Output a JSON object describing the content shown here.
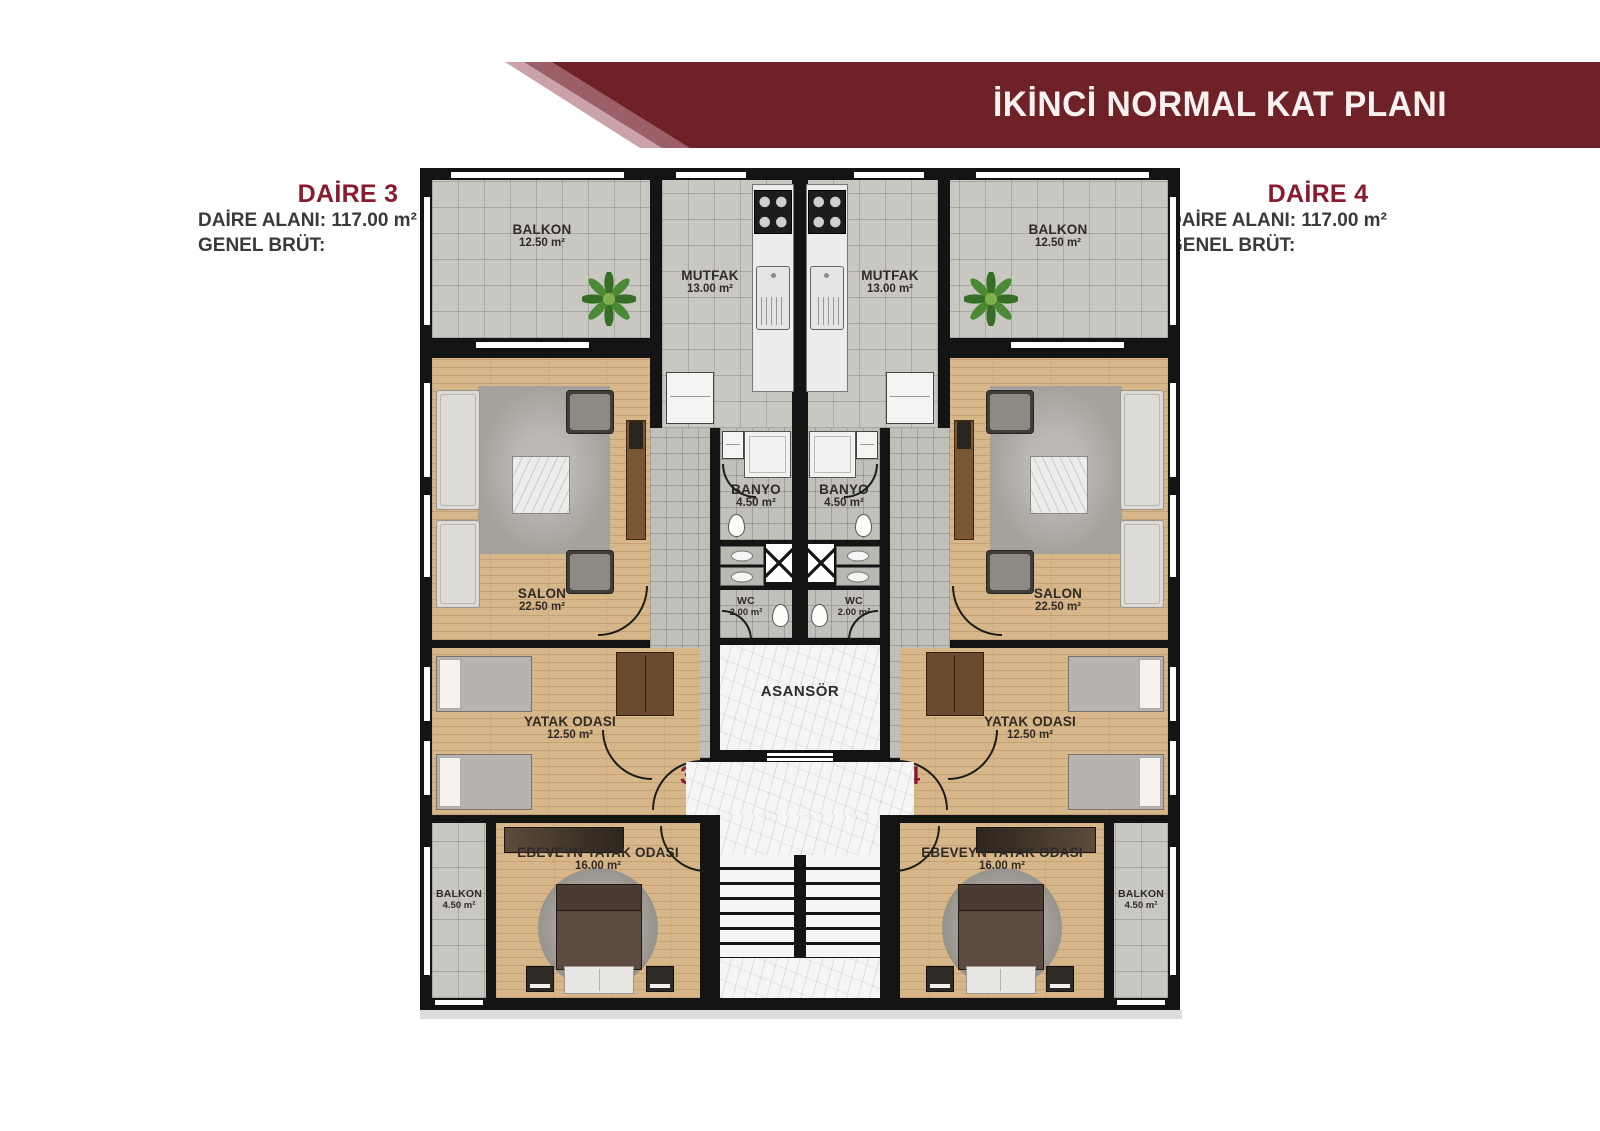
{
  "header": {
    "title": "İKİNCİ NORMAL KAT PLANI"
  },
  "apartments": {
    "left": {
      "name": "DAİRE 3",
      "area_line": "DAİRE ALANI: 117.00 m²",
      "gross_line": "GENEL BRÜT:",
      "door_number": "3"
    },
    "right": {
      "name": "DAİRE 4",
      "area_line": "DAİRE ALANI: 117.00 m²",
      "gross_line": "GENEL BRÜT:",
      "door_number": "4"
    }
  },
  "rooms": {
    "balkon_top": {
      "name": "BALKON",
      "area": "12.50 m²"
    },
    "mutfak": {
      "name": "MUTFAK",
      "area": "13.00 m²"
    },
    "salon": {
      "name": "SALON",
      "area": "22.50 m²"
    },
    "banyo": {
      "name": "BANYO",
      "area": "4.50 m²"
    },
    "wc": {
      "name": "WC",
      "area": "2.00 m²"
    },
    "yatak": {
      "name": "YATAK ODASI",
      "area": "12.50 m²"
    },
    "ebeveyn": {
      "name": "EBEVEYN YATAK ODASI",
      "area": "16.00 m²"
    },
    "balkon_side": {
      "name": "BALKON",
      "area": "4.50 m²"
    },
    "asansor": {
      "name": "ASANSÖR"
    }
  },
  "colors": {
    "banner_dark": "#6e2127",
    "banner_mid": "#9d5f67",
    "banner_light": "#c9a3a8",
    "accent": "#8a1a2e"
  }
}
